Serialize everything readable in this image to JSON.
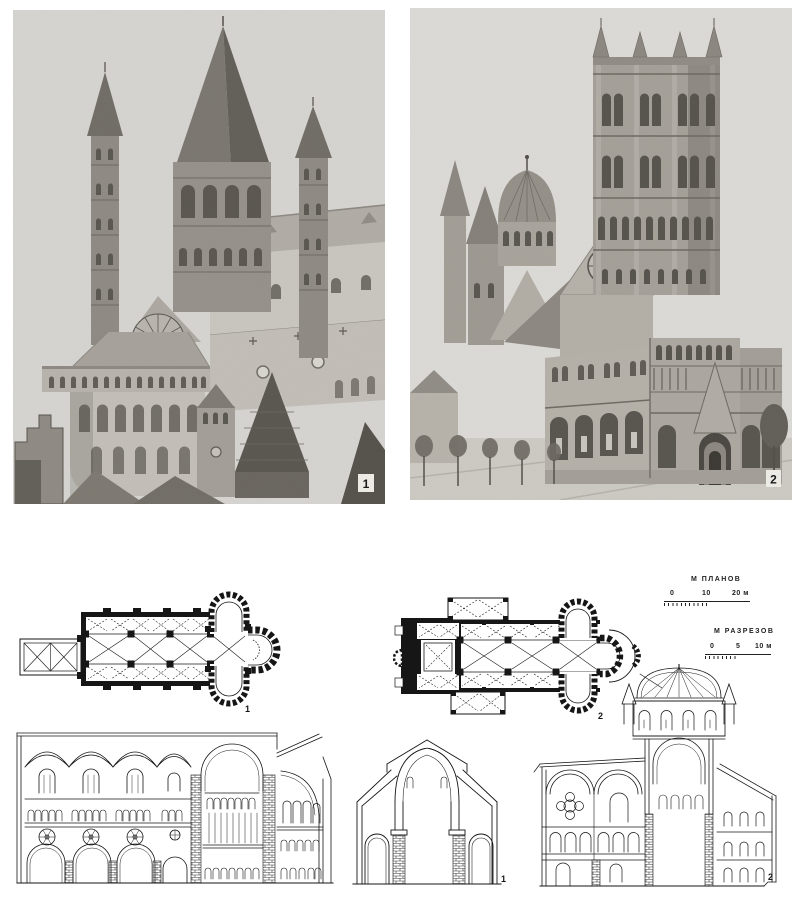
{
  "colors": {
    "page_bg": "#ffffff",
    "ink": "#1b1b1b",
    "photo1_sky": "#d6d5d1",
    "photo2_sky": "#dcdbd7"
  },
  "photos": {
    "photo1": {
      "label": "1"
    },
    "photo2": {
      "label": "2"
    }
  },
  "plans": {
    "plan1": {
      "label": "1"
    },
    "plan2": {
      "label": "2"
    }
  },
  "sections": {
    "cross_section": {
      "label": "1"
    },
    "section2": {
      "label": "2"
    }
  },
  "scale_bars": {
    "plans": {
      "title": "М ПЛАНОВ",
      "ticks": [
        "0",
        "10",
        "20 м"
      ]
    },
    "sections": {
      "title": "М РАЗРЕЗОВ",
      "ticks": [
        "0",
        "5",
        "10 м"
      ]
    }
  }
}
